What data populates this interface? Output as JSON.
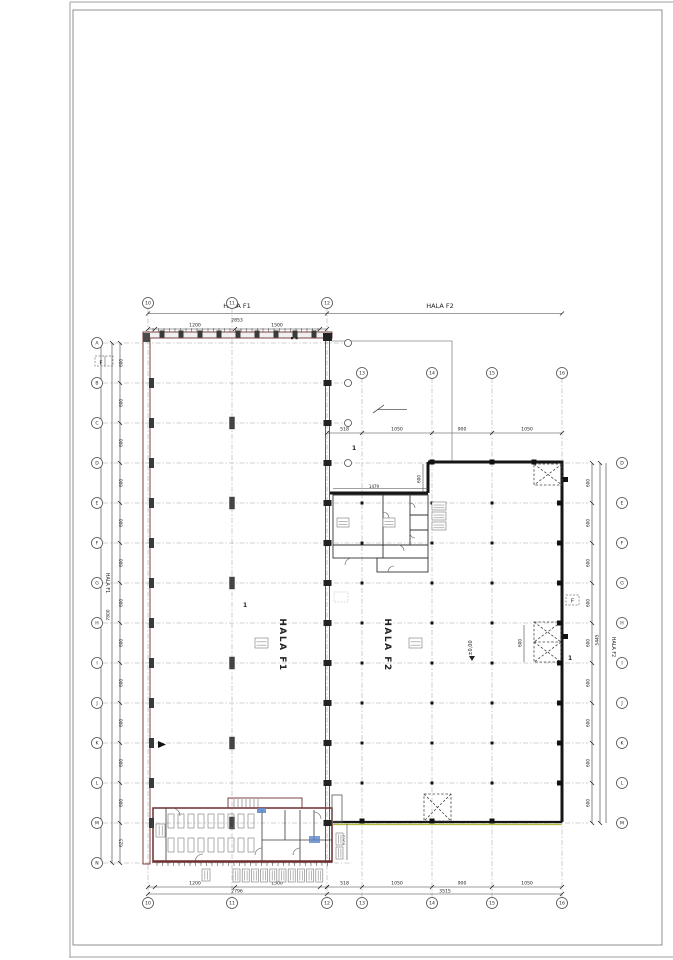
{
  "sheet": {
    "background": "#ffffff",
    "frame_color": "#8f8f8f"
  },
  "colors": {
    "f1_wall": "#6e2f2f",
    "f2_wall": "#161616",
    "grid": "#a3a3a3",
    "dim": "#3c3c3c",
    "bubble": "#4a4a4a",
    "olive_highlight": "#b4bc3e",
    "blue_item": "#5b86c9",
    "hatch": "#9a9a9a"
  },
  "labels": {
    "hala_f1_top": "HALA F1",
    "hala_f2_top": "HALA F2",
    "hala_f1_big": "HALA F1",
    "hala_f2_big": "HALA F2",
    "hala_f1_side": "HALA F1",
    "hala_f2_side": "HALA F2",
    "level": "±0,00",
    "f_left": "F",
    "f_right": "F",
    "detail_1": "1",
    "asterisks": "**"
  },
  "dims": {
    "f1_top_total": "2853",
    "f1_top_segs": [
      "1200",
      "1500"
    ],
    "f1_bottom_segs": [
      "1200",
      "1500"
    ],
    "f1_bottom_total": "2796",
    "f2_segs": [
      "518",
      "1050",
      "900",
      "1050"
    ],
    "f2_bottom_total": "3515",
    "left_steps": [
      "600",
      "600",
      "600",
      "600",
      "600",
      "600",
      "600",
      "600",
      "600",
      "600",
      "600",
      "600",
      "625"
    ],
    "left_total": "7800",
    "right_steps": [
      "600",
      "600",
      "600",
      "600",
      "600",
      "600",
      "600",
      "600",
      "600"
    ],
    "right_total": "5445",
    "inner_600_a": "600",
    "inner_600_b": "600",
    "inner_width": "1479",
    "office_side": "6365"
  },
  "axes": {
    "f1_cols": [
      "10",
      "11",
      "12"
    ],
    "f2_cols": [
      "13",
      "14",
      "15",
      "16"
    ],
    "left_rows": [
      "A",
      "B",
      "C",
      "D",
      "E",
      "F",
      "G",
      "H",
      "I",
      "J",
      "K",
      "L",
      "M",
      "N"
    ],
    "right_rows": [
      "D",
      "E",
      "F",
      "G",
      "H",
      "I",
      "J",
      "K",
      "L",
      "M"
    ]
  }
}
